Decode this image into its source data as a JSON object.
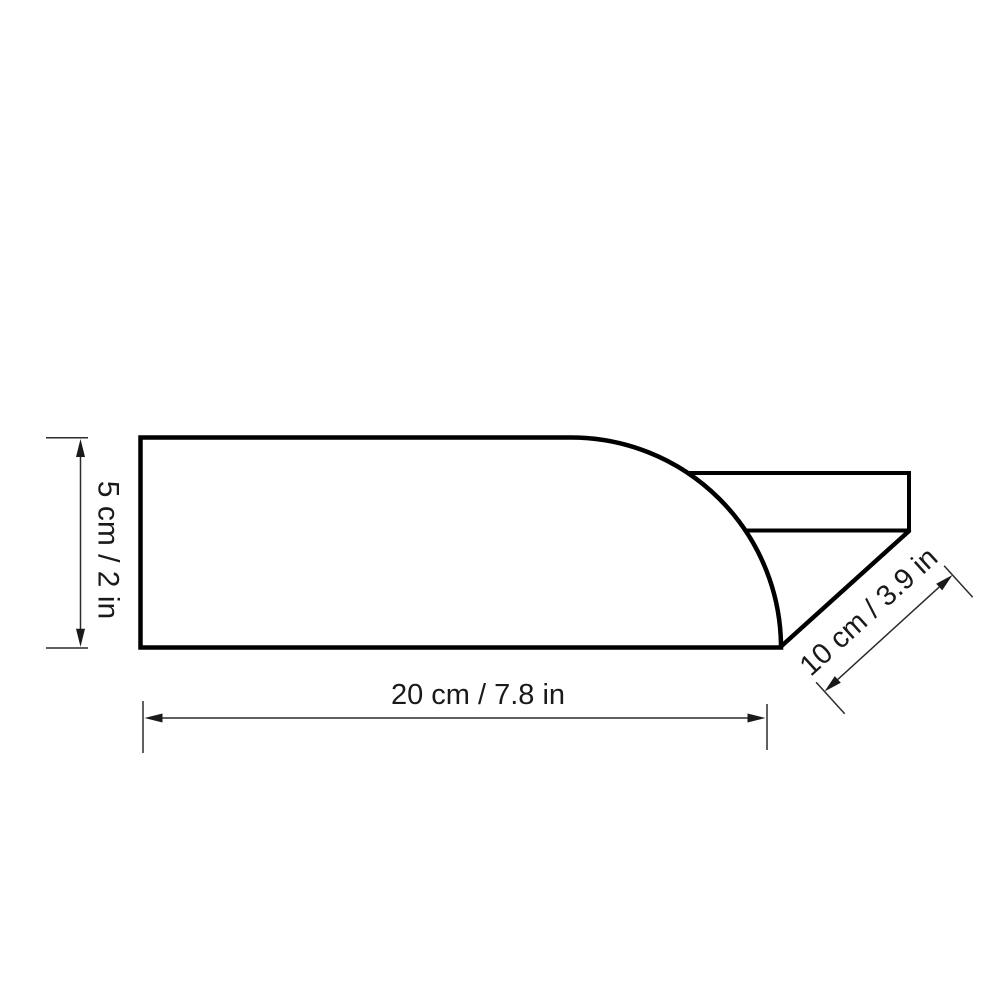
{
  "drawing": {
    "background_color": "#ffffff",
    "outline_color": "#000000",
    "dimension_line_color": "#2b2b2b",
    "label_color": "#1a1a1a",
    "dimensions": {
      "height": {
        "label": "5 cm / 2 in"
      },
      "length": {
        "label": "20 cm / 7.8 in"
      },
      "spout_length": {
        "label": "10 cm / 3.9 in"
      }
    }
  }
}
